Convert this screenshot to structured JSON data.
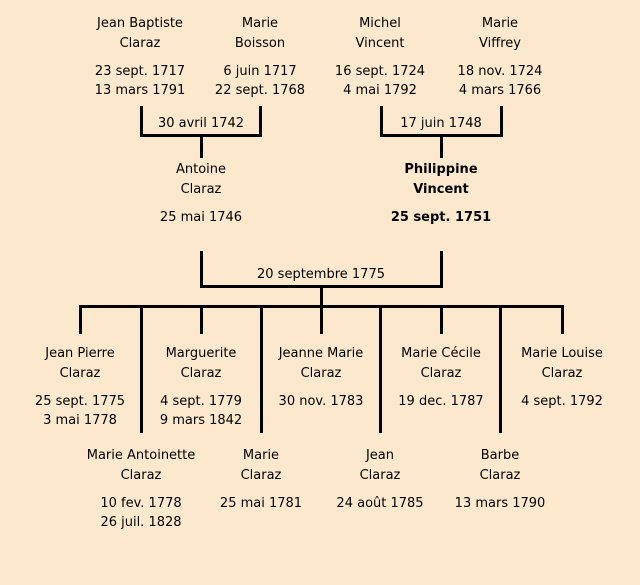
{
  "colors": {
    "background": "#fce9cd",
    "line": "#000000",
    "text": "#000000"
  },
  "gen1": [
    {
      "first": "Jean Baptiste",
      "last": "Claraz",
      "birth": "23 sept. 1717",
      "death": "13 mars 1791"
    },
    {
      "first": "Marie",
      "last": "Boisson",
      "birth": "6 juin 1717",
      "death": "22 sept. 1768"
    },
    {
      "first": "Michel",
      "last": "Vincent",
      "birth": "16 sept. 1724",
      "death": "4 mai 1792"
    },
    {
      "first": "Marie",
      "last": "Viffrey",
      "birth": "18 nov. 1724",
      "death": "4 mars 1766"
    }
  ],
  "marriages": [
    {
      "label": "30 avril 1742"
    },
    {
      "label": "17 juin 1748"
    },
    {
      "label": "20 septembre 1775"
    }
  ],
  "gen2": [
    {
      "first": "Antoine",
      "last": "Claraz",
      "birth": "25 mai 1746"
    },
    {
      "first": "Philippine",
      "last": "Vincent",
      "birth": "25 sept. 1751"
    }
  ],
  "gen3_row1": [
    {
      "first": "Jean Pierre",
      "last": "Claraz",
      "birth": "25 sept. 1775",
      "death": "3 mai 1778"
    },
    {
      "first": "Marguerite",
      "last": "Claraz",
      "birth": "4 sept. 1779",
      "death": "9 mars 1842"
    },
    {
      "first": "Jeanne Marie",
      "last": "Claraz",
      "birth": "30 nov. 1783",
      "death": ""
    },
    {
      "first": "Marie Cécile",
      "last": "Claraz",
      "birth": "19 dec. 1787",
      "death": ""
    },
    {
      "first": "Marie Louise",
      "last": "Claraz",
      "birth": "4 sept. 1792",
      "death": ""
    }
  ],
  "gen3_row2": [
    {
      "first": "Marie Antoinette",
      "last": "Claraz",
      "birth": "10 fev. 1778",
      "death": "26 juil. 1828"
    },
    {
      "first": "Marie",
      "last": "Claraz",
      "birth": "25 mai 1781",
      "death": ""
    },
    {
      "first": "Jean",
      "last": "Claraz",
      "birth": "24 août 1785",
      "death": ""
    },
    {
      "first": "Barbe",
      "last": "Claraz",
      "birth": "13 mars 1790",
      "death": ""
    }
  ]
}
